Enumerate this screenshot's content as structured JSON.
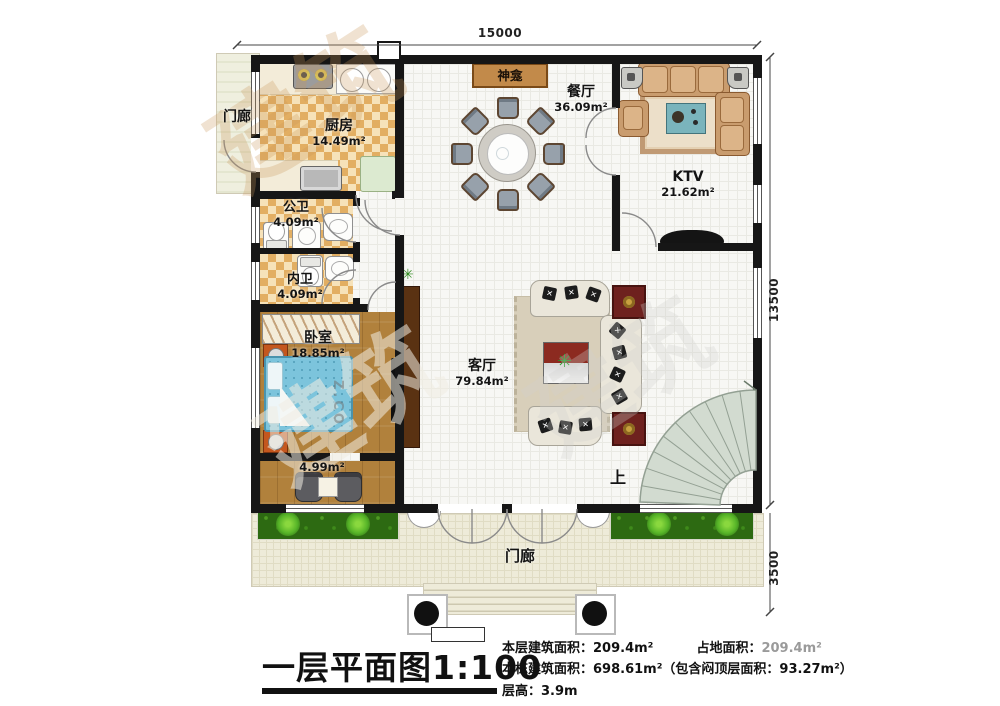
{
  "dimensions": {
    "width_top": "15000",
    "height_right": "13500",
    "porch_depth": "3500"
  },
  "rooms": {
    "porch_left": {
      "name": "门廊"
    },
    "kitchen": {
      "name": "厨房",
      "area": "14.49m²"
    },
    "shrine": {
      "name": "神龛"
    },
    "dining": {
      "name": "餐厅",
      "area": "36.09m²"
    },
    "ktv": {
      "name": "KTV",
      "area": "21.62m²"
    },
    "public_bath": {
      "name": "公卫",
      "area": "4.09m²"
    },
    "inner_bath": {
      "name": "内卫",
      "area": "4.09m²"
    },
    "bedroom": {
      "name": "卧室",
      "area": "18.85m²"
    },
    "balcony": {
      "area": "4.99m²"
    },
    "living": {
      "name": "客厅",
      "area": "79.84m²"
    },
    "stair": {
      "up_label": "上"
    },
    "porch_bottom": {
      "name": "门廊"
    }
  },
  "title_block": {
    "title": "一层平面图1:100",
    "floor_area_label": "本层建筑面积：",
    "floor_area_value": "209.4m²",
    "land_area_label": "占地面积：",
    "land_area_value": "209.4m²",
    "building_area_label": "本栋建筑面积：",
    "building_area_value": "698.61m²（包含闷顶层面积：93.27m²）",
    "height_label": "层高：",
    "height_value": "3.9m"
  },
  "watermark": {
    "text_cn": "建筑",
    "text_latin": "Z.CO"
  },
  "colors": {
    "wall": "#161616",
    "checker_tile": "#e2ae62",
    "wood_floor": "#b1813c",
    "bed": "#7cc4dc",
    "hedge": "#2d6a12",
    "plant": "#6cc62e",
    "shrine_banner": "#c28a4a",
    "side_table": "#6e211e",
    "stair_tread": "#d2dbd0"
  }
}
